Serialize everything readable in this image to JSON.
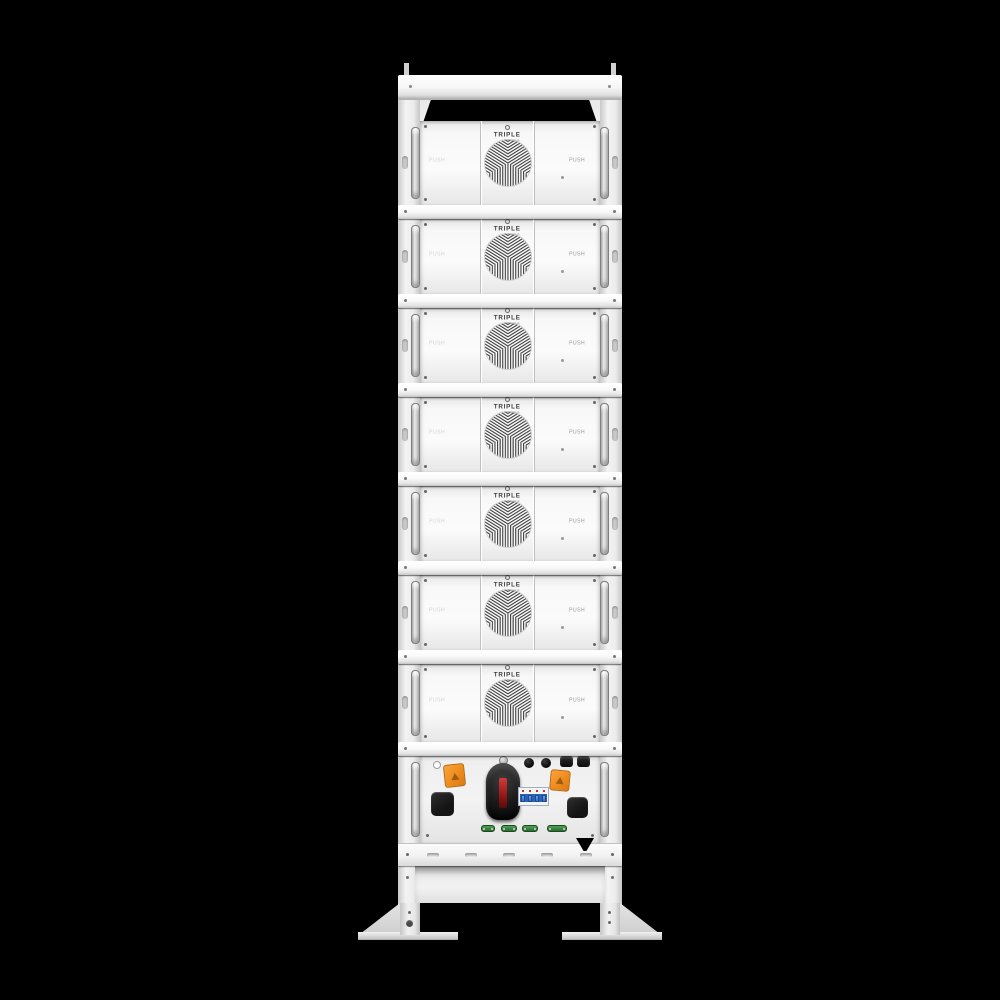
{
  "background": "#000000",
  "brand": {
    "name_top": "TRIPLE",
    "name_bottom": "POWER"
  },
  "module": {
    "count": 7,
    "push_label": "PUSH"
  },
  "rack": {
    "shelf_count": 7,
    "control_unit_components": [
      "indicator-hole",
      "orange-warning-connector-left",
      "orange-warning-connector-right",
      "rubber-pad-left",
      "rubber-pad-right",
      "rotary-disconnect-switch",
      "dc-breaker-4pole",
      "round-plug-1",
      "round-plug-2",
      "cap-plug-1",
      "cap-plug-2",
      "green-comm-port-1",
      "green-comm-port-2",
      "green-comm-port-3",
      "green-comm-port-4"
    ]
  },
  "colors": {
    "orange": "#ef8b1d",
    "redStripe": "#8e1414",
    "breakerBlue": "#2a62b8",
    "toggleBlue": "#6da2e8",
    "green": "#2c6b31",
    "greenDark": "#1d4a21"
  }
}
